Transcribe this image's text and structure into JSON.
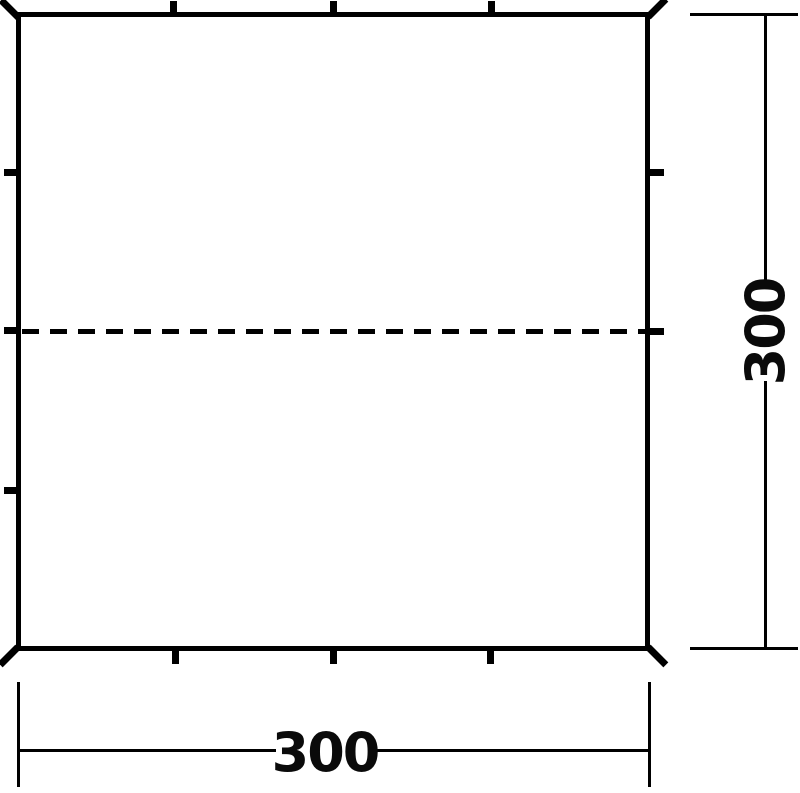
{
  "diagram": {
    "subject": "square-tarp-dimension-drawing",
    "width_dimension": {
      "label": "300"
    },
    "height_dimension": {
      "label": "300"
    },
    "colors": {
      "line": "#000000",
      "background": "#ffffff",
      "text": "#0a0a0a"
    }
  }
}
